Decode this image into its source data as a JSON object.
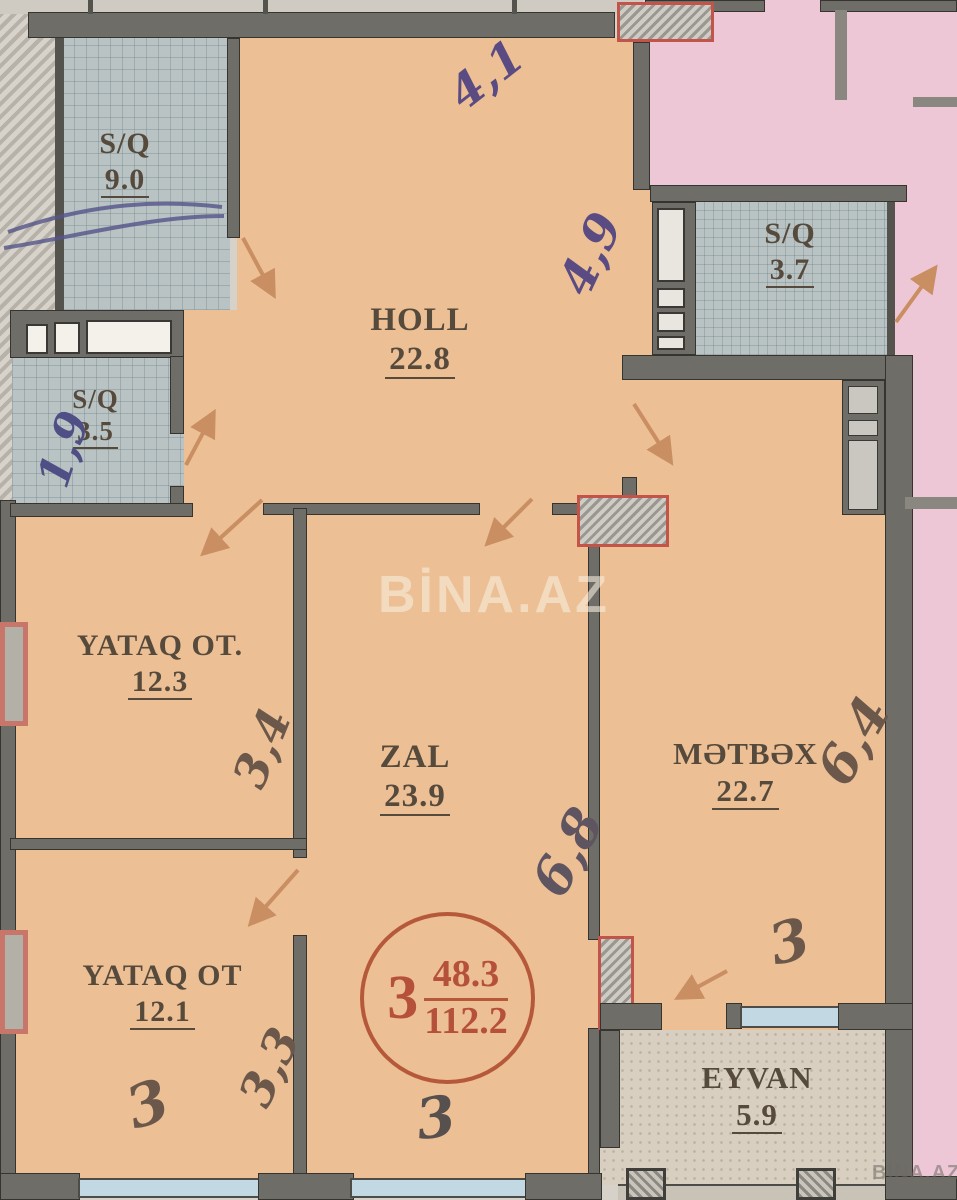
{
  "watermarks": {
    "center": "BİNA.AZ",
    "corner": "BINA.AZ"
  },
  "rooms": [
    {
      "name": "S/Q",
      "area": "9.0"
    },
    {
      "name": "S/Q",
      "area": "3.5"
    },
    {
      "name": "S/Q",
      "area": "3.7"
    },
    {
      "name": "HOLL",
      "area": "22.8"
    },
    {
      "name": "YATAQ OT.",
      "area": "12.3"
    },
    {
      "name": "ZAL",
      "area": "23.9"
    },
    {
      "name": "MƏTBƏX",
      "area": "22.7"
    },
    {
      "name": "YATAQ OT",
      "area": "12.1"
    },
    {
      "name": "EYVAN",
      "area": "5.9"
    }
  ],
  "stamp": {
    "room_count": "3",
    "living_area": "48.3",
    "total_area": "112.2"
  },
  "handwritten": [
    {
      "id": "holl-top-width",
      "text": "4,1"
    },
    {
      "id": "holl-height",
      "text": "4,9"
    },
    {
      "id": "sq35-width",
      "text": "1,9"
    },
    {
      "id": "yataq1-width",
      "text": "3,4"
    },
    {
      "id": "zal-height",
      "text": "6,8"
    },
    {
      "id": "metbex-height",
      "text": "6,4"
    },
    {
      "id": "yataq2-width",
      "text": "3,3"
    },
    {
      "id": "yataq2-length",
      "text": "3"
    },
    {
      "id": "zal-width",
      "text": "3"
    },
    {
      "id": "metbex-width",
      "text": "3"
    }
  ],
  "colors": {
    "floor_orange": "#ecbf95",
    "neighbor_pink": "#eec7d6",
    "wall_gray": "#6f6d67",
    "tile_gray": "#b9c3c4",
    "shaft_red": "#c3544a",
    "stamp_red": "#b5503a",
    "door_arrow": "#c98e62",
    "pen_blue": "#5a4b82"
  }
}
